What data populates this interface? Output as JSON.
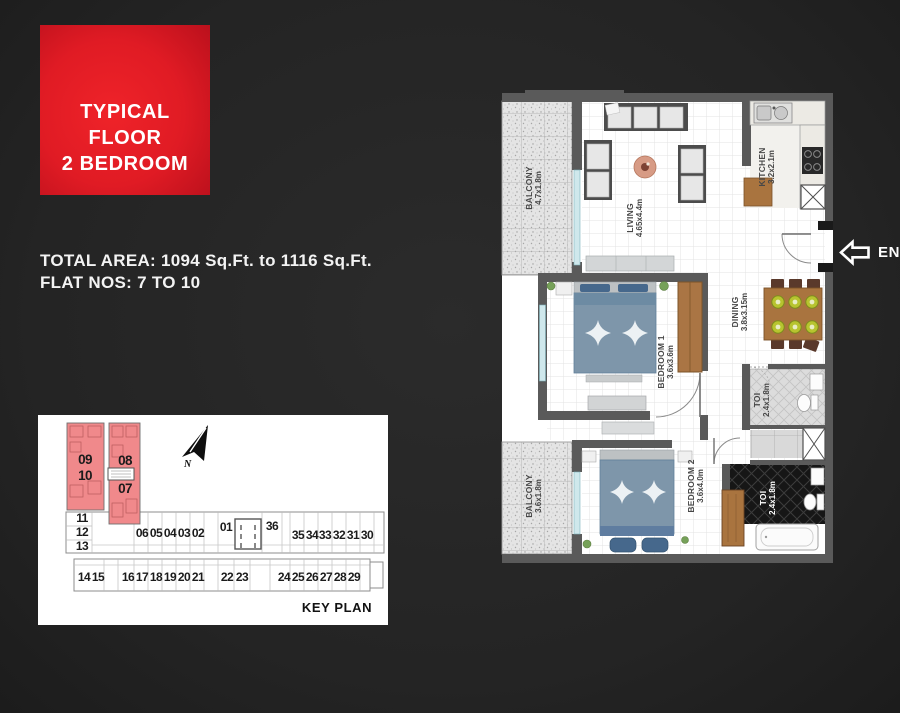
{
  "badge": {
    "line1": "TYPICAL",
    "line2": "FLOOR",
    "line3": "2 BEDROOM"
  },
  "info": {
    "total_area": "TOTAL AREA: 1094 Sq.Ft. to 1116 Sq.Ft.",
    "flat_nos": "FLAT NOS: 7 TO 10"
  },
  "key_plan": {
    "title": "KEY PLAN",
    "highlighted_units": [
      "07",
      "08",
      "09",
      "10"
    ],
    "units": [
      {
        "n": "09",
        "x": 47,
        "y": 49,
        "big": true
      },
      {
        "n": "10",
        "x": 47,
        "y": 65,
        "big": true
      },
      {
        "n": "08",
        "x": 87,
        "y": 50,
        "big": true
      },
      {
        "n": "07",
        "x": 87,
        "y": 78,
        "big": true
      },
      {
        "n": "11",
        "x": 44,
        "y": 107
      },
      {
        "n": "12",
        "x": 44,
        "y": 121
      },
      {
        "n": "13",
        "x": 44,
        "y": 135
      },
      {
        "n": "06",
        "x": 104,
        "y": 122
      },
      {
        "n": "05",
        "x": 118,
        "y": 122
      },
      {
        "n": "04",
        "x": 132,
        "y": 122
      },
      {
        "n": "03",
        "x": 146,
        "y": 122
      },
      {
        "n": "02",
        "x": 160,
        "y": 122
      },
      {
        "n": "01",
        "x": 188,
        "y": 116
      },
      {
        "n": "36",
        "x": 234,
        "y": 115
      },
      {
        "n": "35",
        "x": 260,
        "y": 124
      },
      {
        "n": "34",
        "x": 274,
        "y": 124
      },
      {
        "n": "33",
        "x": 287,
        "y": 124
      },
      {
        "n": "32",
        "x": 301,
        "y": 124
      },
      {
        "n": "31",
        "x": 315,
        "y": 124
      },
      {
        "n": "30",
        "x": 329,
        "y": 124
      },
      {
        "n": "14",
        "x": 46,
        "y": 166
      },
      {
        "n": "15",
        "x": 60,
        "y": 166
      },
      {
        "n": "16",
        "x": 90,
        "y": 166
      },
      {
        "n": "17",
        "x": 104,
        "y": 166
      },
      {
        "n": "18",
        "x": 118,
        "y": 166
      },
      {
        "n": "19",
        "x": 132,
        "y": 166
      },
      {
        "n": "20",
        "x": 146,
        "y": 166
      },
      {
        "n": "21",
        "x": 160,
        "y": 166
      },
      {
        "n": "22",
        "x": 189,
        "y": 166
      },
      {
        "n": "23",
        "x": 204,
        "y": 166
      },
      {
        "n": "24",
        "x": 246,
        "y": 166
      },
      {
        "n": "25",
        "x": 260,
        "y": 166
      },
      {
        "n": "26",
        "x": 274,
        "y": 166
      },
      {
        "n": "27",
        "x": 288,
        "y": 166
      },
      {
        "n": "28",
        "x": 302,
        "y": 166
      },
      {
        "n": "29",
        "x": 316,
        "y": 166
      }
    ]
  },
  "floor_plan": {
    "entry_label": "ENTRY",
    "rooms": [
      {
        "id": "balcony1",
        "name": "BALCONY",
        "dims": "4.7x1.8m"
      },
      {
        "id": "living",
        "name": "LIVING",
        "dims": "4.65x4.4m"
      },
      {
        "id": "kitchen",
        "name": "KITCHEN",
        "dims": "3.2x2.1m"
      },
      {
        "id": "dining",
        "name": "DINING",
        "dims": "3.8x3.15m"
      },
      {
        "id": "bedroom1",
        "name": "BEDROOM 1",
        "dims": "3.6x3.6m"
      },
      {
        "id": "toi1",
        "name": "TOI",
        "dims": "2.4x1.8m"
      },
      {
        "id": "balcony2",
        "name": "BALCONY",
        "dims": "3.6x1.8m"
      },
      {
        "id": "bedroom2",
        "name": "BEDROOM 2",
        "dims": "3.6x4.0m"
      },
      {
        "id": "toi2",
        "name": "TOI",
        "dims": "2.4x1.8m"
      }
    ],
    "icons": {
      "north": "north-arrow",
      "entry": "left-arrow-outline"
    }
  },
  "colors": {
    "background": "#242424",
    "badge_red": "#e01b24",
    "keyplan_highlight": "#f0898b",
    "wall_gray": "#5a5a5a",
    "bed_blue": "#7e96aa",
    "wood": "#aa7544",
    "window_teal": "#cfe8ec"
  }
}
